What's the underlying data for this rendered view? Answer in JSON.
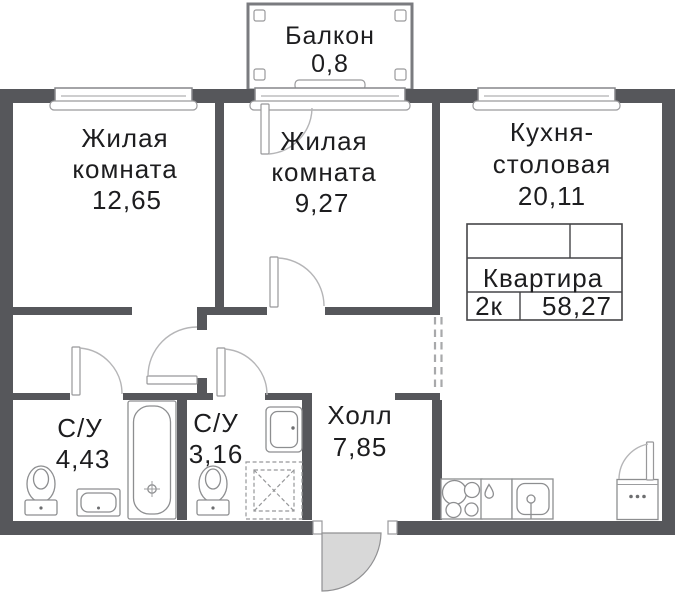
{
  "rooms": {
    "balcony": {
      "name": "Балкон",
      "area": "0,8"
    },
    "living1": {
      "name1": "Жилая",
      "name2": "комната",
      "area": "12,65"
    },
    "living2": {
      "name1": "Жилая",
      "name2": "комната",
      "area": "9,27"
    },
    "kitchen": {
      "name1": "Кухня-",
      "name2": "столовая",
      "area": "20,11"
    },
    "bathroom1": {
      "name": "С/У",
      "area": "4,43"
    },
    "bathroom2": {
      "name": "С/У",
      "area": "3,16"
    },
    "hall": {
      "name": "Холл",
      "area": "7,85"
    }
  },
  "info_table": {
    "title": "Квартира",
    "rooms_label": "2к",
    "total_area": "58,27"
  },
  "colors": {
    "wall": "#56575b",
    "fixture_line": "#8d8e90",
    "door_arc": "#b5b5b7",
    "entrance_door_fill": "#d8d8d8",
    "table_border": "#454548",
    "text": "#1d1d1f",
    "background": "#ffffff"
  }
}
